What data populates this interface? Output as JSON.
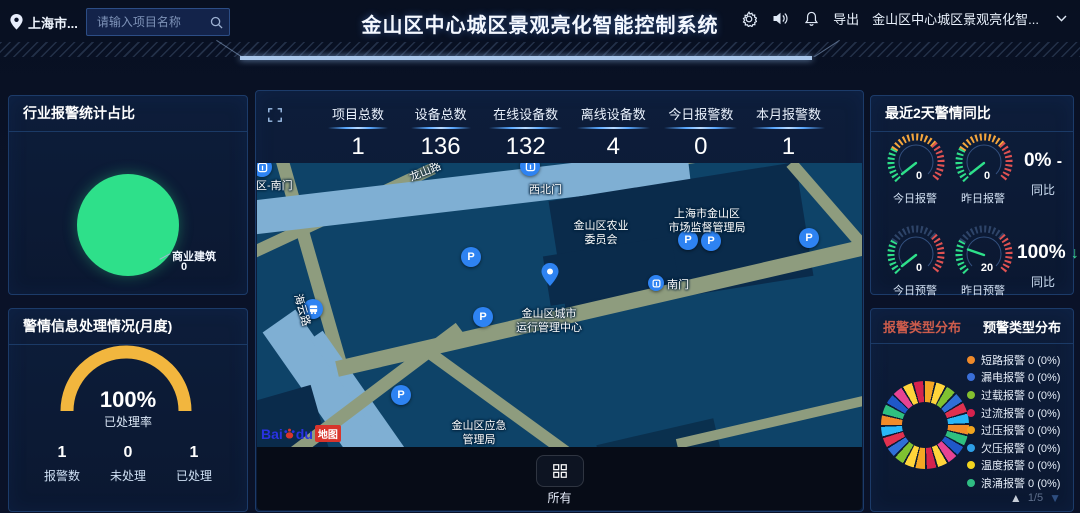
{
  "header": {
    "location_label": "上海市...",
    "search_placeholder": "请输入项目名称",
    "title": "金山区中心城区景观亮化智能控制系统",
    "export_label": "导出",
    "project_name": "金山区中心城区景观亮化智..."
  },
  "left": {
    "industry": {
      "title": "行业报警统计占比",
      "slice_label": "商业建筑",
      "slice_value": "0",
      "slice_color": "#2ee08a"
    },
    "monthly": {
      "title": "警情信息处理情况(月度)",
      "rate": "100%",
      "rate_label": "已处理率",
      "gauge_color": "#f2b63e",
      "stats": [
        {
          "value": "1",
          "label": "报警数"
        },
        {
          "value": "0",
          "label": "未处理"
        },
        {
          "value": "1",
          "label": "已处理"
        }
      ]
    }
  },
  "center": {
    "stats": [
      {
        "label": "项目总数",
        "value": "1"
      },
      {
        "label": "设备总数",
        "value": "136"
      },
      {
        "label": "在线设备数",
        "value": "132"
      },
      {
        "label": "离线设备数",
        "value": "4"
      },
      {
        "label": "今日报警数",
        "value": "0"
      },
      {
        "label": "本月报警数",
        "value": "1"
      }
    ],
    "map": {
      "labels": [
        {
          "text": "西区-南门"
        },
        {
          "text": "龙山路"
        },
        {
          "text": "西北门"
        },
        {
          "text": "金山区农业\n委员会"
        },
        {
          "text": "上海市金山区\n市场监督管理局"
        },
        {
          "text": "南门"
        },
        {
          "text": "金山区城市\n运行管理中心"
        },
        {
          "text": "海云路"
        },
        {
          "text": "金山区应急\n管理局"
        }
      ],
      "attribution_bai": "Bai",
      "attribution_du": "du",
      "attribution_map": "地图"
    },
    "footer": {
      "all_label": "所有"
    }
  },
  "right": {
    "trend": {
      "title": "最近2天警情同比",
      "rows": [
        {
          "gauges": [
            {
              "value": "0",
              "label": "今日报警"
            },
            {
              "value": "0",
              "label": "昨日报警"
            }
          ],
          "pct": "0%",
          "arrow": "-",
          "pct_label": "同比"
        },
        {
          "gauges": [
            {
              "value": "0",
              "label": "今日预警"
            },
            {
              "value": "20",
              "label": "昨日预警"
            }
          ],
          "pct": "100%",
          "arrow": "↓",
          "pct_label": "同比"
        }
      ]
    },
    "types": {
      "tab_alarm": "报警类型分布",
      "tab_warning": "预警类型分布",
      "legend": [
        {
          "label": "短路报警 0 (0%)",
          "color": "#ef8a2a"
        },
        {
          "label": "漏电报警 0 (0%)",
          "color": "#3a6fd8"
        },
        {
          "label": "过载报警 0 (0%)",
          "color": "#84c02f"
        },
        {
          "label": "过流报警 0 (0%)",
          "color": "#d6224e"
        },
        {
          "label": "过压报警 0 (0%)",
          "color": "#f0a51f"
        },
        {
          "label": "欠压报警 0 (0%)",
          "color": "#2e9fe6"
        },
        {
          "label": "温度报警 0 (0%)",
          "color": "#f2d41f"
        },
        {
          "label": "浪涌报警 0 (0%)",
          "color": "#2fbd83"
        }
      ],
      "donut_palette": [
        "#f5a623",
        "#ffd43b",
        "#7fc131",
        "#2f6fd8",
        "#e0314f",
        "#29b6f6",
        "#f28b28",
        "#2fbf7f",
        "#1f58c9",
        "#e84393",
        "#ffd43b",
        "#d6224e"
      ],
      "page": "1/5"
    }
  }
}
